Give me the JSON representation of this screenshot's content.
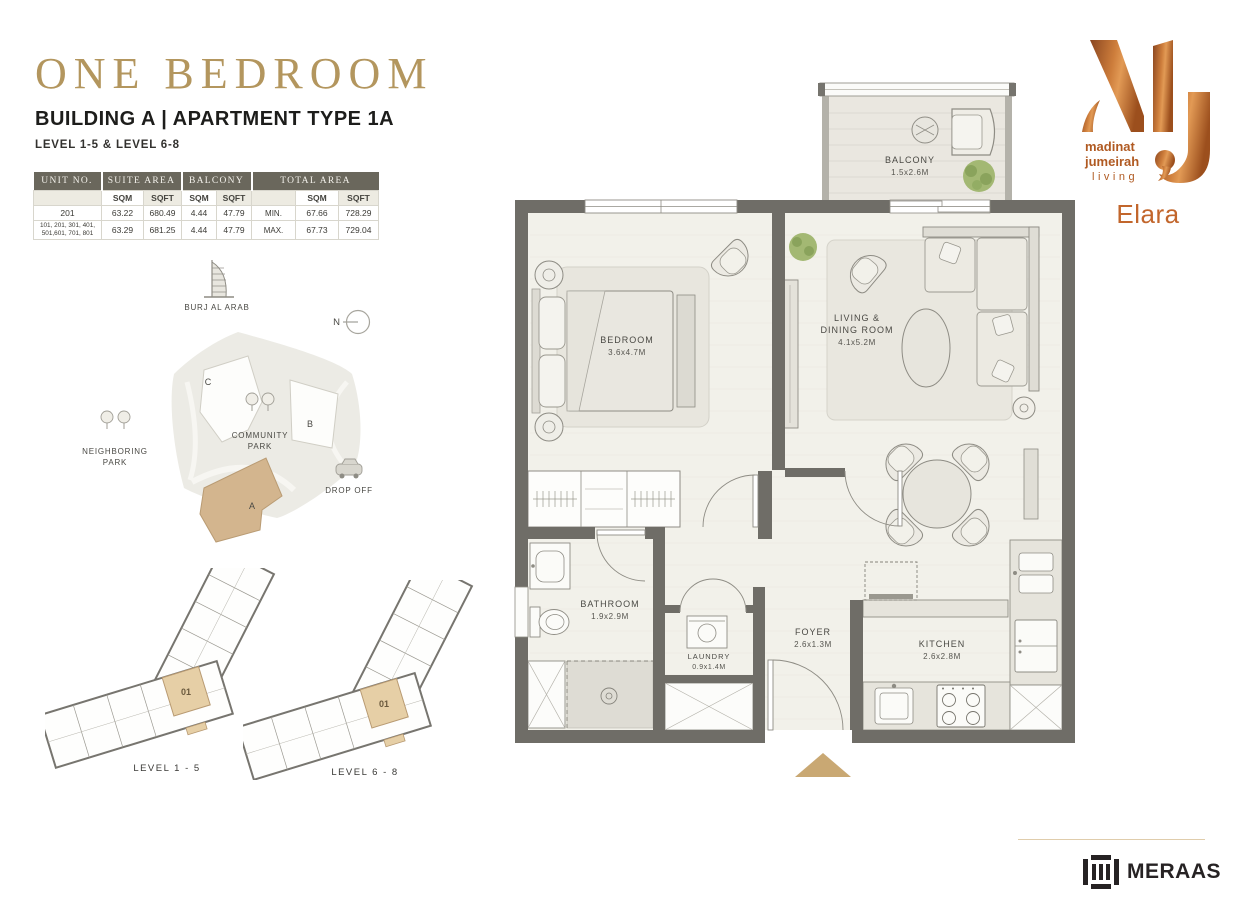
{
  "header": {
    "title": "ONE BEDROOM",
    "subtitle": "BUILDING A | APARTMENT TYPE 1A",
    "levels": "LEVEL 1-5 & LEVEL 6-8"
  },
  "area_table": {
    "col_headers": {
      "unit_no": "UNIT NO.",
      "suite_area": "SUITE AREA",
      "balcony": "BALCONY",
      "total_area": "TOTAL AREA"
    },
    "unit_labels": {
      "sqm": "SQM",
      "sqft": "SQFT"
    },
    "rows": [
      {
        "unit_no": "201",
        "suite_sqm": "63.22",
        "suite_sqft": "680.49",
        "balcony_sqm": "4.44",
        "balcony_sqft": "47.79",
        "range_label": "MIN.",
        "total_sqm": "67.66",
        "total_sqft": "728.29"
      },
      {
        "unit_no": "101, 201, 301, 401, 501,601, 701, 801",
        "suite_sqm": "63.29",
        "suite_sqft": "681.25",
        "balcony_sqm": "4.44",
        "balcony_sqft": "47.79",
        "range_label": "MAX.",
        "total_sqm": "67.73",
        "total_sqft": "729.04"
      }
    ]
  },
  "site_map": {
    "burj_label": "BURJ AL ARAB",
    "north_label": "N",
    "building_a": "A",
    "building_b": "B",
    "building_c": "C",
    "community_park_1": "COMMUNITY",
    "community_park_2": "PARK",
    "neighboring_park_1": "NEIGHBORING",
    "neighboring_park_2": "PARK",
    "drop_off": "DROP OFF"
  },
  "key_plans": [
    {
      "unit": "01",
      "label": "LEVEL 1 - 5"
    },
    {
      "unit": "01",
      "label": "LEVEL 6 - 8"
    }
  ],
  "floor_plan": {
    "balcony": {
      "name": "BALCONY",
      "dims": "1.5x2.6M"
    },
    "bedroom": {
      "name": "BEDROOM",
      "dims": "3.6x4.7M"
    },
    "living": {
      "name_1": "LIVING &",
      "name_2": "DINING ROOM",
      "dims": "4.1x5.2M"
    },
    "bathroom": {
      "name": "BATHROOM",
      "dims": "1.9x2.9M"
    },
    "laundry": {
      "name": "LAUNDRY",
      "dims": "0.9x1.4M"
    },
    "foyer": {
      "name": "FOYER",
      "dims": "2.6x1.3M"
    },
    "kitchen": {
      "name": "KITCHEN",
      "dims": "2.6x2.8M"
    }
  },
  "branding": {
    "mj_line_1": "madinat",
    "mj_line_2": "jumeirah",
    "mj_line_3": "living",
    "project_name": "Elara",
    "developer": "MERAAS"
  },
  "colors": {
    "title_gold": "#b3965e",
    "accent_tan": "#c9a873",
    "copper": "#bc6a2e",
    "wall_gray": "#6f6d67",
    "table_header_bg": "#6a675c"
  }
}
